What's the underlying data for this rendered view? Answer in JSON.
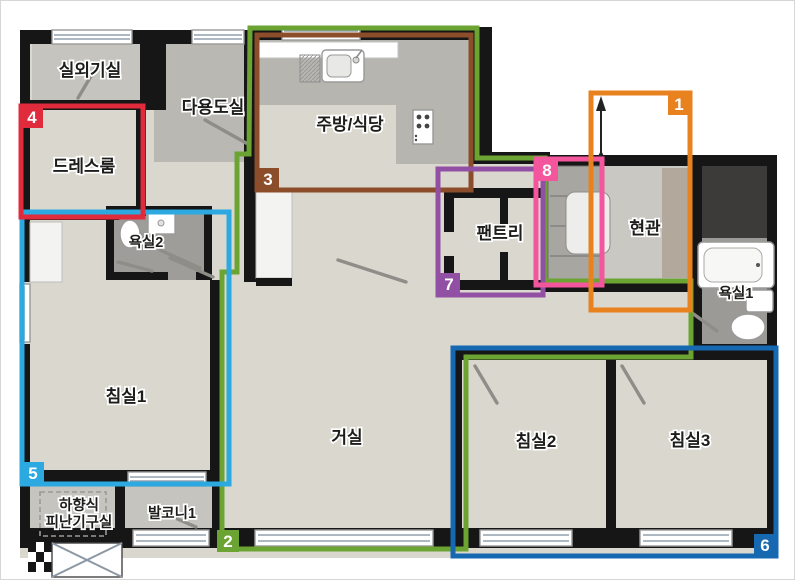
{
  "title": "apartment-floor-plan",
  "rooms": [
    {
      "id": "outdoor-unit-room",
      "label": "실외기실"
    },
    {
      "id": "utility-room",
      "label": "다용도실"
    },
    {
      "id": "kitchen-dining",
      "label": "주방/식당"
    },
    {
      "id": "dress-room",
      "label": "드레스룸"
    },
    {
      "id": "bathroom-2",
      "label": "욕실2"
    },
    {
      "id": "pantry",
      "label": "팬트리"
    },
    {
      "id": "entrance",
      "label": "현관"
    },
    {
      "id": "bathroom-1",
      "label": "욕실1"
    },
    {
      "id": "bedroom-1",
      "label": "침실1"
    },
    {
      "id": "living-room",
      "label": "거실"
    },
    {
      "id": "bedroom-2",
      "label": "침실2"
    },
    {
      "id": "bedroom-3",
      "label": "침실3"
    },
    {
      "id": "evacuation-room",
      "label_line1": "하향식",
      "label_line2": "피난기구실"
    },
    {
      "id": "balcony-1",
      "label": "발코니1"
    }
  ],
  "zones": [
    {
      "number": "1",
      "color": "#E8821E"
    },
    {
      "number": "2",
      "color": "#6CA433"
    },
    {
      "number": "3",
      "color": "#8C4D2B"
    },
    {
      "number": "4",
      "color": "#E02B3C"
    },
    {
      "number": "5",
      "color": "#2BA9E0"
    },
    {
      "number": "6",
      "color": "#1668B0"
    },
    {
      "number": "7",
      "color": "#9150A4"
    },
    {
      "number": "8",
      "color": "#F4569E"
    }
  ],
  "palette": {
    "wall": "#161616",
    "floor_beige": "#DAD7CF",
    "floor_gray": "#C6C4BE",
    "floor_mid_gray": "#BAB8B2",
    "floor_dark_gray": "#9E9D99",
    "counter": "#B7B5B0",
    "shoe_closet_tan": "#B2A89B"
  }
}
